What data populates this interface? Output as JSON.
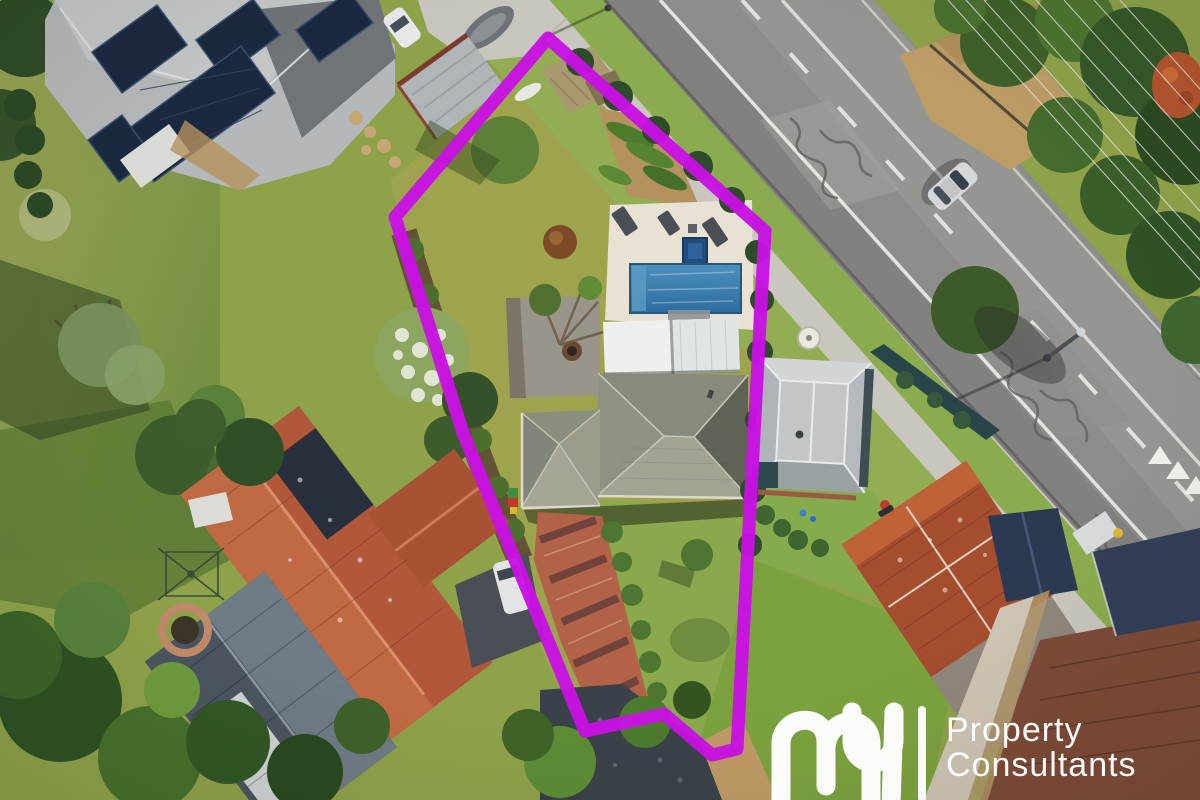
{
  "scene": {
    "alt": "Aerial drone photograph of a residential property outlined with a magenta boundary line, featuring a tiled-roof house, swimming pool and spa, rear lawn and sheds, neighbouring homes with terracotta and metal roofs, and a main road with lane markings on the right."
  },
  "boundary": {
    "color": "#c911e4",
    "stroke_width": "13",
    "points": "548,38 765,231 737,749 712,755 664,714 585,731 463,433 395,217"
  },
  "watermark": {
    "brand_script": "my",
    "line1": "Property",
    "line2": "Consultants",
    "color": "#ffffff"
  }
}
